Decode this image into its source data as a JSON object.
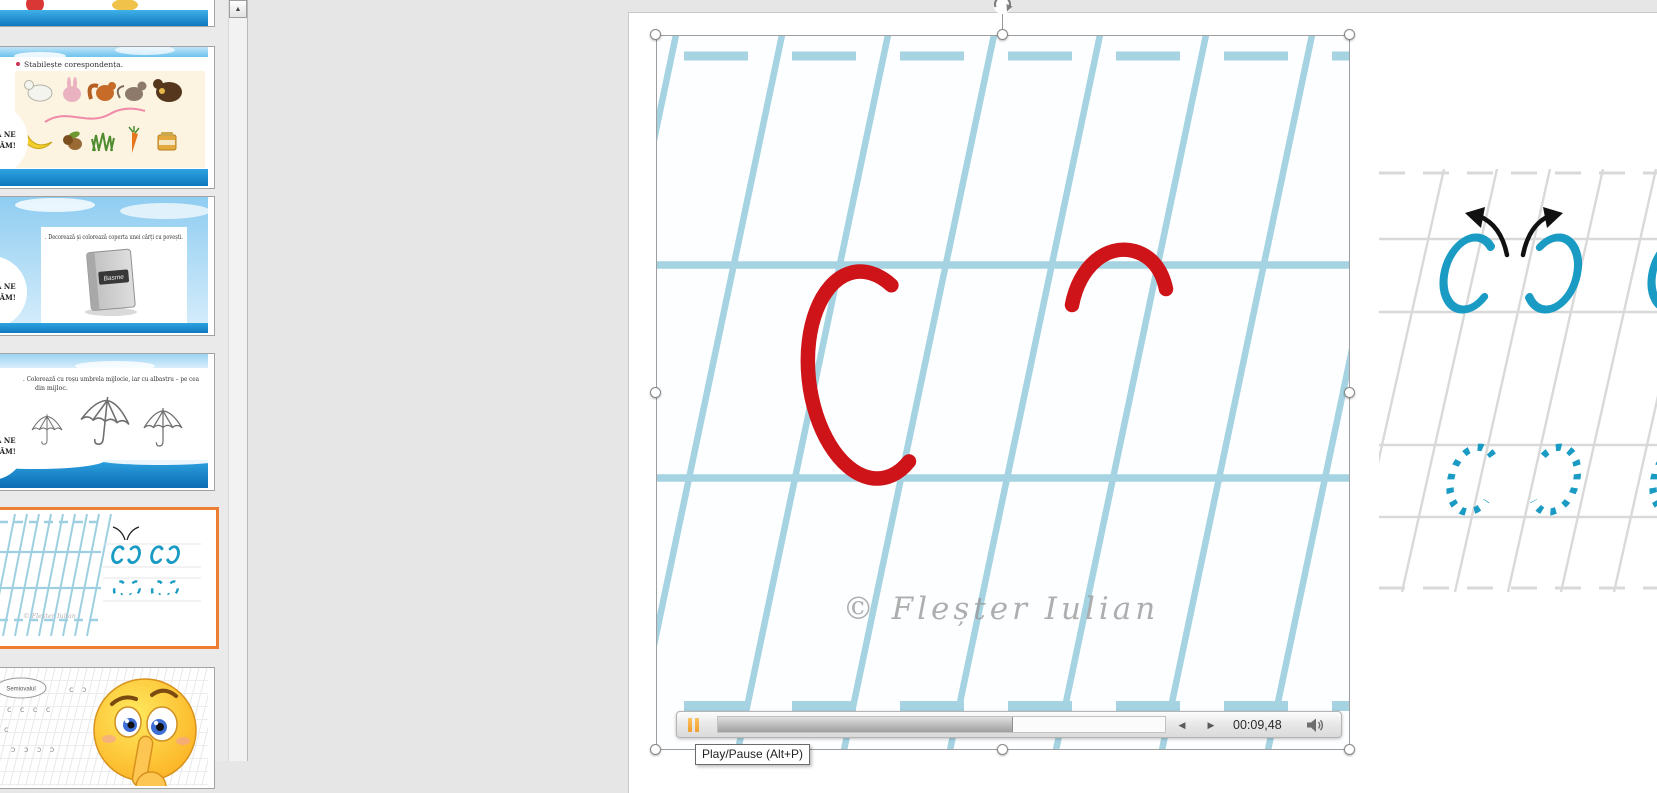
{
  "window": {
    "app": "presentation-editor",
    "view": "normal-edit-with-selected-video"
  },
  "colors": {
    "teal_letter": "#1a9bc3",
    "red_letter": "#ce1418",
    "video_grid_blue": "#a5d3e2",
    "practice_grid_gray": "#d9d9d9",
    "selected_thumb_border": "#ed7d31",
    "pause_icon_orange": "#f5a33b",
    "sky_band_blue": "#2a9ede"
  },
  "sidebar": {
    "scroll_up_icon": "▲",
    "thumbnails": [
      {
        "id": 1,
        "partial": true
      },
      {
        "id": 2,
        "title": "Stabilește corespondența.",
        "badge_line1": "Ă NE",
        "badge_line2": "CĂM!"
      },
      {
        "id": 3,
        "title": ". Decorează și colorează coperta unei cărți cu povești.",
        "book_label": "Basme",
        "badge_line1": "Ă NE",
        "badge_line2": "CĂM!"
      },
      {
        "id": 4,
        "title_line1": ". Colorează cu roșu umbrela mijlocie, iar cu albastru – pe cea",
        "title_line2": "din mijloc.",
        "badge_line1": "Ă NE",
        "badge_line2": "CĂM!"
      },
      {
        "id": 5,
        "selected": true,
        "watermark": "© Fleșter Iulian"
      },
      {
        "id": 6,
        "label": "Semiovalul",
        "row1": "c ɔ",
        "row2": "c c c c",
        "row3": "c c",
        "row4": "ɔ ɔ ɔ ɔ"
      }
    ]
  },
  "slide": {
    "video_watermark": "© Fleșter Iulian",
    "practice": {
      "row1_letters": [
        "C",
        "Ɔ",
        "C",
        "Ɔ"
      ],
      "row2_letters_dotted": [
        "C",
        "Ɔ",
        "C",
        "Ɔ"
      ]
    }
  },
  "media_controls": {
    "state": "playing",
    "time": "00:09,48",
    "progress_percent": 66,
    "step_back_glyph": "◀",
    "step_forward_glyph": "▶",
    "tooltip": "Play/Pause (Alt+P)"
  }
}
